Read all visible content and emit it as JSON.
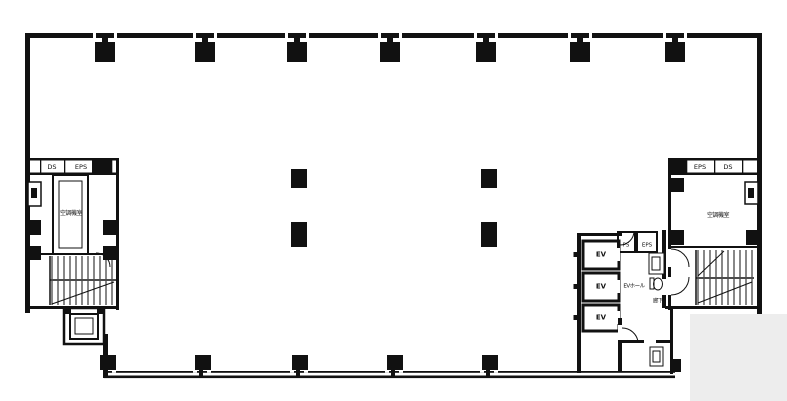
{
  "plan": {
    "left_core": {
      "duct_label": "DS",
      "eps_label": "EPS",
      "room_label": "空調機室"
    },
    "right_core": {
      "eps_label": "EPS",
      "duct_label": "DS",
      "room_label": "空調機室"
    },
    "elevator_core": {
      "elevators": [
        {
          "label": "EV"
        },
        {
          "label": "EV"
        },
        {
          "label": "EV"
        }
      ],
      "ps_label": "PS",
      "eps_label": "EPS",
      "hall_label": "EVホール",
      "corridor_label": "廊下"
    }
  },
  "colors": {
    "wall": "#111111",
    "background": "#ffffff",
    "covered_area": "#ededed"
  }
}
